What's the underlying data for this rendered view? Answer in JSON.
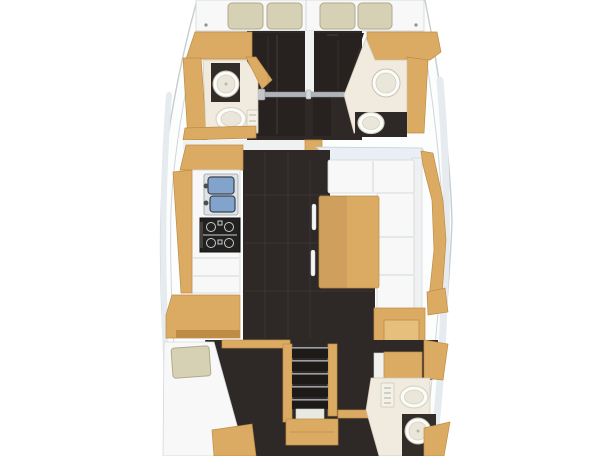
{
  "canvas": {
    "width": 608,
    "height": 456
  },
  "palette": {
    "pageBg": "#ffffff",
    "hullFill": "#fcfdfd",
    "hullLine": "#c7ccd0",
    "hullShade": "#e6ebef",
    "floor": "#2e2926",
    "floorSeam": "#6b625a",
    "bed": "#272220",
    "wood": "#dcab63",
    "woodDark": "#bf8c45",
    "woodLight": "#e7bf7d",
    "cream": "#f0ebde",
    "white": "#f7f8f7",
    "seam": "#d3d8db",
    "cushion": "#d6d0b4",
    "cushionLine": "#b2aa8c",
    "sinkBlue": "#82a3cb",
    "steel": "#39434e",
    "metal": "#aeb4b9",
    "stove": "#23211f",
    "stoveDetail": "#c9cdd0",
    "toilet": "#fbfbf8",
    "toiletLine": "#d7d4c6",
    "panel": "#f3f1e8",
    "window": "#e9eff5",
    "windowLine": "#c3cdd5",
    "divider": "#f0f1f1",
    "counterDark": "#332d29"
  },
  "plan": {
    "type": "yacht-interior-floor-plan",
    "orientation": {
      "stern": "top",
      "bow": "bottom"
    },
    "rooms": [
      {
        "id": "transom-berth",
        "label": "Stern berth platform",
        "fixtures": [
          "cushion",
          "cushion",
          "cushion",
          "cushion"
        ]
      },
      {
        "id": "aft-cabin-port",
        "label": "Aft cabin port",
        "fixtures": [
          "double-berth"
        ]
      },
      {
        "id": "aft-cabin-starboard",
        "label": "Aft cabin starboard",
        "fixtures": [
          "double-berth"
        ]
      },
      {
        "id": "head-aft-port",
        "label": "Aft head port",
        "fixtures": [
          "washbasin",
          "toilet",
          "control-panel"
        ]
      },
      {
        "id": "head-aft-starboard",
        "label": "Aft head starboard",
        "fixtures": [
          "washbasin",
          "toilet"
        ]
      },
      {
        "id": "companionway",
        "label": "Companionway",
        "fixtures": [
          "grab-rail"
        ]
      },
      {
        "id": "galley",
        "label": "Galley port side",
        "fixtures": [
          "double-sink",
          "stove",
          "counter"
        ]
      },
      {
        "id": "salon",
        "label": "Salon starboard side",
        "fixtures": [
          "l-settee",
          "table",
          "grab-posts"
        ]
      },
      {
        "id": "nav-station",
        "label": "Chart table starboard",
        "fixtures": [
          "desk"
        ]
      },
      {
        "id": "forward-cabin-port",
        "label": "Forward cabin port",
        "fixtures": [
          "berth",
          "pillow",
          "dresser"
        ]
      },
      {
        "id": "forward-steps",
        "label": "Forward companionway steps",
        "fixtures": [
          "steps"
        ]
      },
      {
        "id": "head-forward-starboard",
        "label": "Forward head starboard",
        "fixtures": [
          "toilet",
          "washbasin",
          "shower-panel"
        ]
      }
    ]
  }
}
